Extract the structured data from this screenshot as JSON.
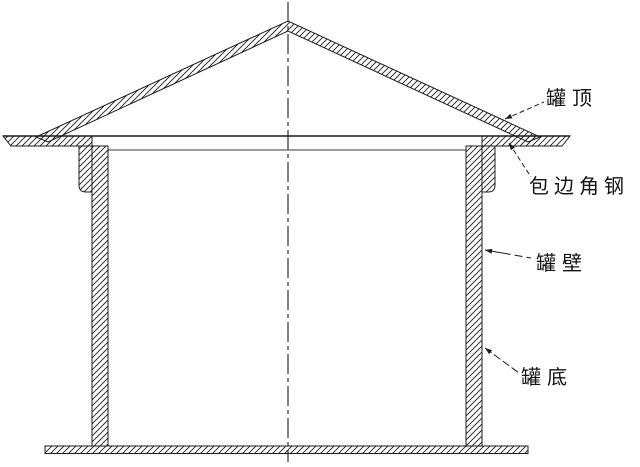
{
  "drawing": {
    "labels": {
      "roof": "罐顶",
      "curb_angle": "包边角钢",
      "wall": "罐壁",
      "bottom": "罐底"
    },
    "colors": {
      "ink": "#1c1c1c",
      "background": "#ffffff"
    }
  }
}
